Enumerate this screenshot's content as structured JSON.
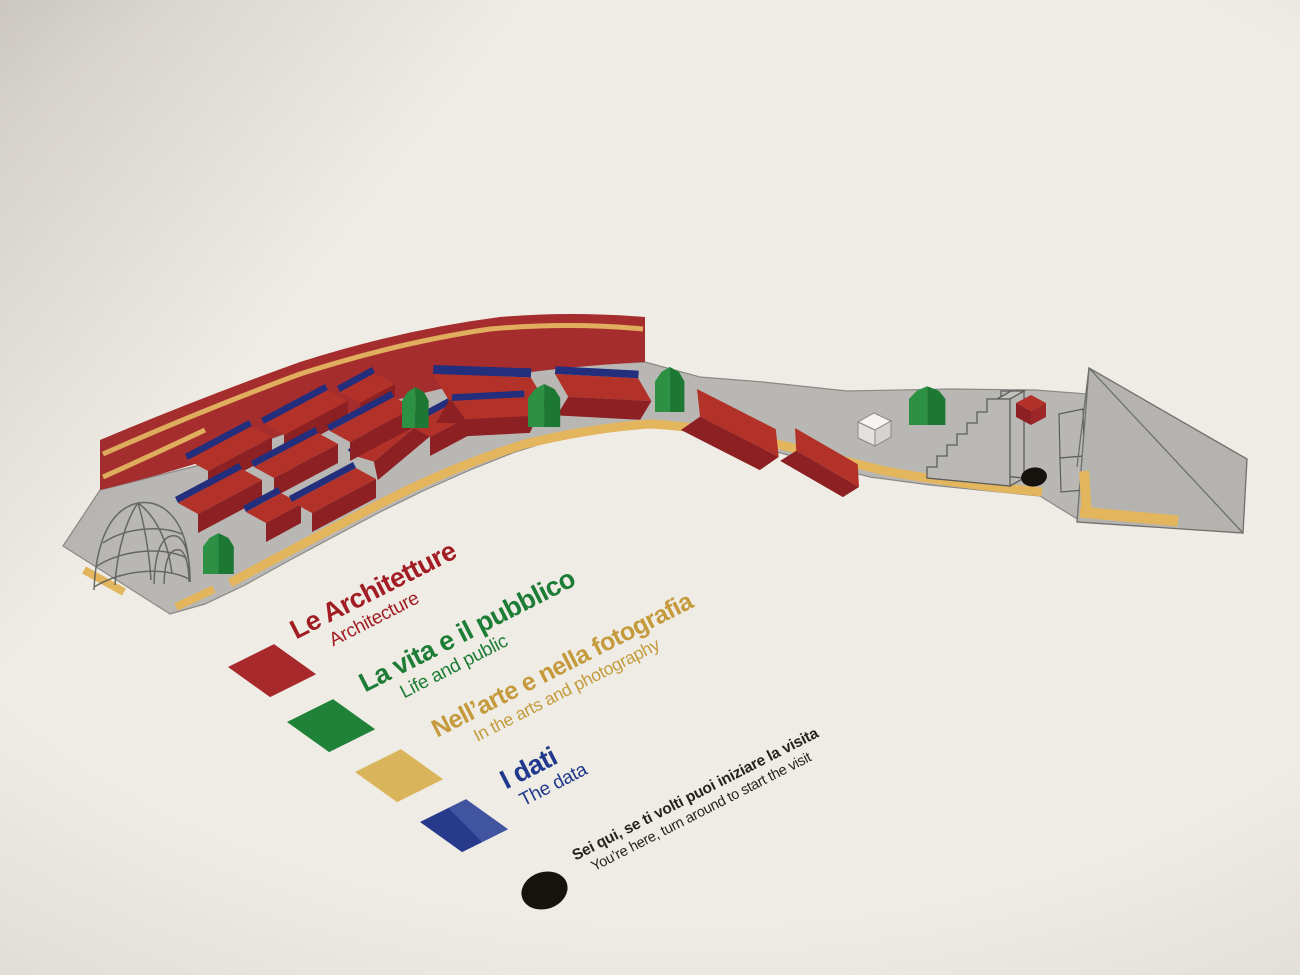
{
  "panel": {
    "name": "exhibition-route-map-panel",
    "background_color": "#EFECE5"
  },
  "map": {
    "name": "isometric-exhibition-route-map",
    "colors": {
      "floor_gray": "#B9B7B4",
      "wall_red": "#A62D2E",
      "exhibit_red": "#B23129",
      "exhibit_red_shadow": "#8D2023",
      "exhibit_blue_edge": "#232E7D",
      "tree_green": "#2D9144",
      "tree_green_shadow": "#1D7833",
      "route_yellow": "#E3B55C",
      "outline_gray": "#5C5C5A",
      "cube_white": "#F5F4F1",
      "marker_black": "#16130F"
    },
    "features": [
      "geodesic-dome",
      "curved-red-wall",
      "yellow-route-stripe",
      "red-exhibit-boxes",
      "green-trees",
      "white-cube",
      "staircase",
      "red-cube",
      "you-are-here-dot",
      "ramp-wedge"
    ]
  },
  "legend": {
    "items": [
      {
        "key": "architecture",
        "swatch_color": "#A8292B",
        "text_color": "#A11D23",
        "label_it": "Le Architetture",
        "label_en": "Architecture"
      },
      {
        "key": "life-and-public",
        "swatch_color": "#1F8238",
        "text_color": "#1D7C35",
        "label_it": "La vita e il pubblico",
        "label_en": "Life and public"
      },
      {
        "key": "arts-and-photography",
        "swatch_color": "#D9B45A",
        "text_color": "#C49A3C",
        "label_it": "Nell’arte e nella fotografia",
        "label_en": "In the arts and photography"
      },
      {
        "key": "the-data",
        "swatch_color": "#27398B",
        "text_color": "#20398C",
        "label_it": "I dati",
        "label_en": "The data"
      }
    ],
    "you_are_here": {
      "marker_color": "#16130F",
      "label_it": "Sei qui, se ti volti puoi iniziare la visita",
      "label_en": "You’re here, turn around to start the visit"
    }
  }
}
